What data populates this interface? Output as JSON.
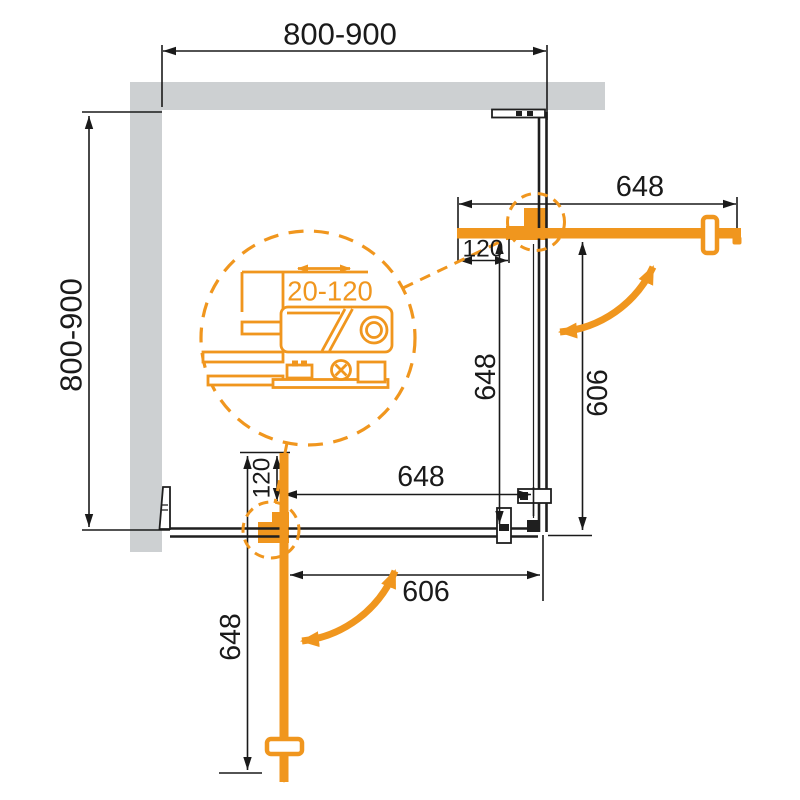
{
  "meta": {
    "type": "technical-drawing",
    "subject": "corner shower enclosure - plan view with pivot doors"
  },
  "colors": {
    "accent_orange": "#F0961E",
    "wall_gray": "#CDD0D2",
    "line_black": "#1A1A1A",
    "background": "#FFFFFF"
  },
  "dims": {
    "top_width": "800-900",
    "side_depth": "800-900",
    "adjust_range": "20-120",
    "right_door": {
      "width": "648",
      "offset": "120",
      "open": "648",
      "fixed": "606"
    },
    "bottom_door": {
      "width": "648",
      "offset": "120",
      "open": "648",
      "fixed": "606"
    }
  }
}
